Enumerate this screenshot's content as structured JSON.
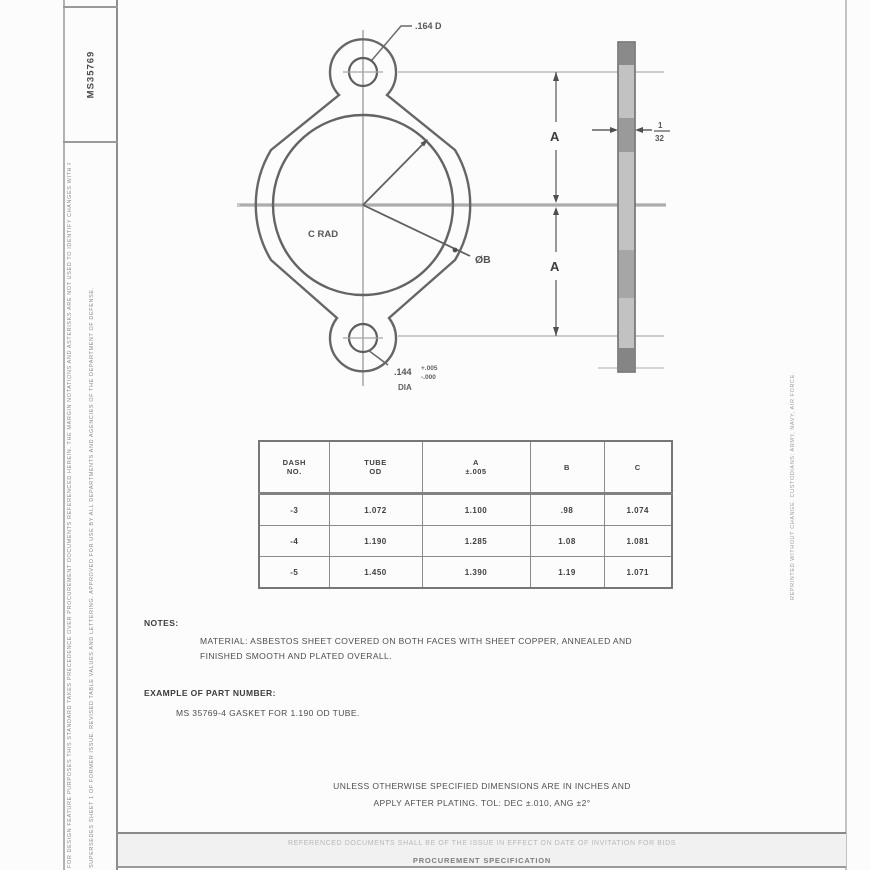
{
  "page": {
    "background": "#fcfcfc",
    "ink_color": "#4f4f4f"
  },
  "sidebar": {
    "sheet_number": "MS35769",
    "margin_note_1": "FOR DESIGN FEATURE PURPOSES THIS STANDARD TAKES PRECEDENCE OVER PROCUREMENT DOCUMENTS REFERENCED HEREIN. THE MARGIN NOTATIONS AND ASTERISKS ARE NOT USED TO IDENTIFY CHANGES WITH RESPECT TO THE PREVIOUS ISSUE OF THIS STANDARD.",
    "margin_note_2": "SUPERSEDES SHEET 1 OF FORMER ISSUE. REVISED TABLE VALUES AND LETTERING. APPROVED FOR USE BY ALL DEPARTMENTS AND AGENCIES OF THE DEPARTMENT OF DEFENSE."
  },
  "right_margin": {
    "note": "REPRINTED WITHOUT CHANGE. CUSTODIANS: ARMY, NAVY, AIR FORCE."
  },
  "drawing": {
    "top_callout": ".164 D",
    "bottom_callout_dim": ".144",
    "bottom_callout_tol_plus": "+.005",
    "bottom_callout_tol_minus": "-.000",
    "bottom_callout_suffix": "DIA",
    "dim_upper": "A",
    "dim_lower": "A",
    "bore_label": "ØB",
    "radius_label": "C RAD",
    "thickness_frac_num": "1",
    "thickness_frac_den": "32"
  },
  "table": {
    "headers": {
      "c1a": "DASH",
      "c1b": "NO.",
      "c2a": "TUBE",
      "c2b": "OD",
      "c3a": "A",
      "c3b": "±.005",
      "c4a": "B",
      "c4b": "",
      "c5a": "C",
      "c5b": ""
    },
    "rows": [
      [
        "-3",
        "1.072",
        "1.100",
        ".98",
        "1.074"
      ],
      [
        "-4",
        "1.190",
        "1.285",
        "1.08",
        "1.081"
      ],
      [
        "-5",
        "1.450",
        "1.390",
        "1.19",
        "1.071"
      ]
    ]
  },
  "notes": {
    "heading": "NOTES:",
    "line1": "MATERIAL: ASBESTOS SHEET COVERED ON BOTH FACES WITH SHEET COPPER, ANNEALED AND",
    "line2": "FINISHED SMOOTH AND PLATED OVERALL.",
    "example_heading": "EXAMPLE OF PART NUMBER:",
    "example_line": "MS 35769-4 GASKET FOR 1.190 OD TUBE."
  },
  "tolerance_block": {
    "line1": "UNLESS OTHERWISE SPECIFIED DIMENSIONS ARE IN INCHES AND",
    "line2": "APPLY AFTER PLATING. TOL: DEC ±.010, ANG ±2°"
  },
  "footer": {
    "reference_line": "REFERENCED DOCUMENTS SHALL BE OF THE ISSUE IN EFFECT ON DATE OF INVITATION FOR BIDS",
    "spec_line": "PROCUREMENT SPECIFICATION"
  }
}
